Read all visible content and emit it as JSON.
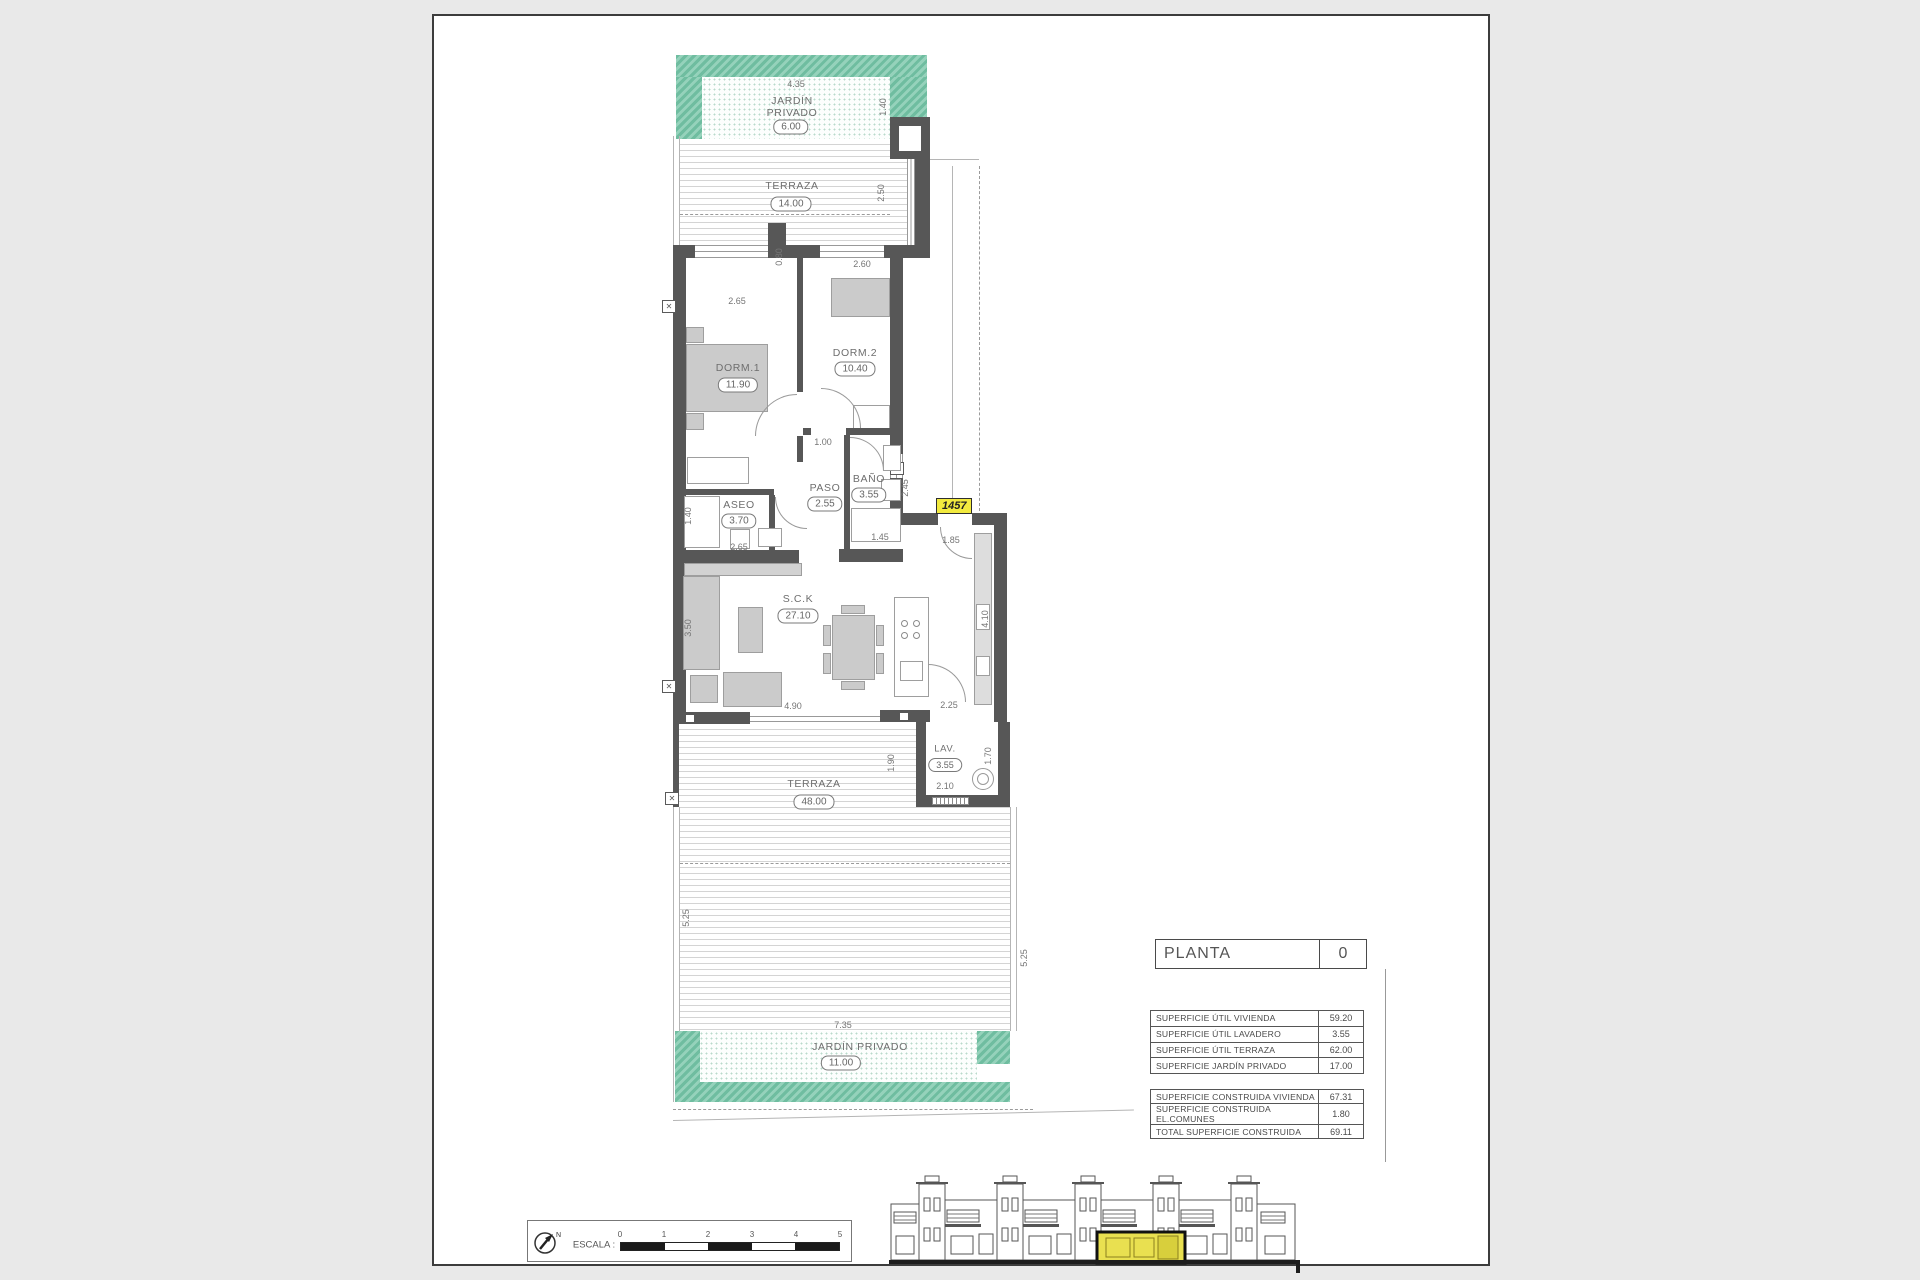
{
  "page": {
    "planta_label": "PLANTA",
    "planta_value": "0"
  },
  "unit_tag": "1457",
  "rooms": {
    "jardin_top": {
      "name_line1": "JARDÍN",
      "name_line2": "PRIVADO",
      "area": "6.00"
    },
    "terraza_top": {
      "name": "TERRAZA",
      "area": "14.00"
    },
    "dorm1": {
      "name": "DORM.1",
      "area": "11.90"
    },
    "dorm2": {
      "name": "DORM.2",
      "area": "10.40"
    },
    "aseo": {
      "name": "ASEO",
      "area": "3.70"
    },
    "paso": {
      "name": "PASO",
      "area": "2.55"
    },
    "bano": {
      "name": "BAÑO",
      "area": "3.55"
    },
    "sck": {
      "name": "S.C.K",
      "area": "27.10"
    },
    "lav": {
      "name": "LAV.",
      "area": "3.55"
    },
    "terraza_bottom": {
      "name": "TERRAZA",
      "area": "48.00"
    },
    "jardin_bottom": {
      "name": "JARDÍN  PRIVADO",
      "area": "11.00"
    }
  },
  "dims": {
    "top_width": "4.35",
    "top_right": "1.40",
    "terraza_top_width": "4.85",
    "terraza_top_depth": "2.50",
    "step": "0.80",
    "dorm1_window": "2.65",
    "dorm2_window": "2.60",
    "dorm1_depth": "4.50",
    "hall": "1.00",
    "bano_depth": "2.45",
    "bano_width": "1.45",
    "aseo_depth": "1.40",
    "aseo_width": "2.65",
    "entry": "1.85",
    "sofa_wall": "3.50",
    "kitchen_wall": "4.10",
    "sck_window": "4.90",
    "lav_pass": "2.25",
    "lav_depth": "1.90",
    "lav_right": "1.70",
    "lav_width": "2.10",
    "terraza_b_left": "5.25",
    "terraza_b_right": "5.25",
    "jardin_b_width": "7.35"
  },
  "tables": {
    "areas_utiles": {
      "rows": [
        {
          "label": "SUPERFICIE ÚTIL VIVIENDA",
          "value": "59.20"
        },
        {
          "label": "SUPERFICIE ÚTIL LAVADERO",
          "value": "3.55"
        },
        {
          "label": "SUPERFICIE ÚTIL TERRAZA",
          "value": "62.00"
        },
        {
          "label": "SUPERFICIE JARDÍN PRIVADO",
          "value": "17.00"
        }
      ]
    },
    "areas_construidas": {
      "rows": [
        {
          "label": "SUPERFICIE CONSTRUIDA VIVIENDA",
          "value": "67.31"
        },
        {
          "label": "SUPERFICIE CONSTRUIDA EL.COMUNES",
          "value": "1.80"
        },
        {
          "label": "TOTAL SUPERFICIE CONSTRUIDA",
          "value": "69.11"
        }
      ]
    }
  },
  "scale_bar": {
    "label": "ESCALA :",
    "ticks": [
      "0",
      "1",
      "2",
      "3",
      "4",
      "5"
    ]
  },
  "colors": {
    "garden_green": "#79c2a3",
    "highlight_yellow": "#e9e050",
    "wall_gray": "#575757"
  }
}
